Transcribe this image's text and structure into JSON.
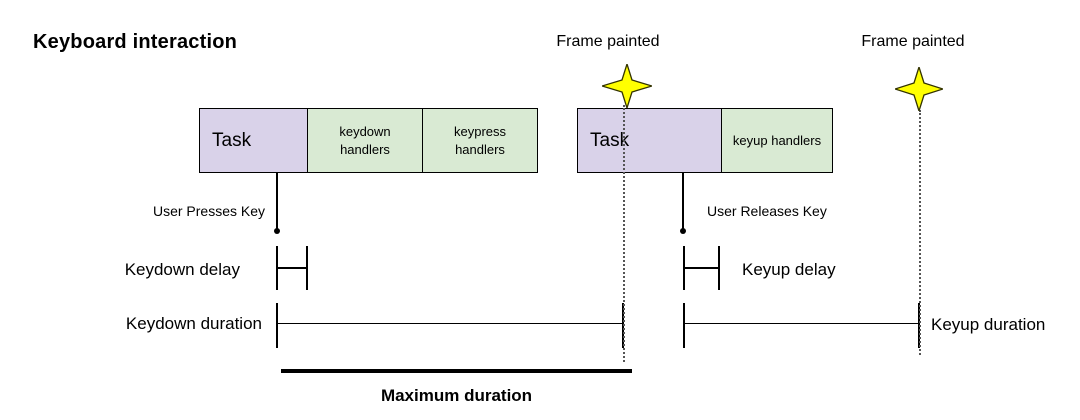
{
  "title": "Keyboard interaction",
  "frame_events": {
    "first": "Frame painted",
    "second": "Frame painted"
  },
  "keydown_track": {
    "task": "Task",
    "keydown_handlers": "keydown\nhandlers",
    "keypress_handlers": "keypress\nhandlers",
    "user_action": "User Presses Key",
    "delay": "Keydown delay",
    "duration": "Keydown duration"
  },
  "keyup_track": {
    "task": "Task",
    "keyup_handlers": "keyup handlers",
    "user_action": "User Releases Key",
    "delay": "Keyup delay",
    "duration": "Keyup duration"
  },
  "maximum_duration": "Maximum duration",
  "colors": {
    "task_fill": "#d9d2e9",
    "handlers_fill": "#d9ead3",
    "star_fill": "#ffff00",
    "star_stroke": "#333300",
    "line": "#000000"
  }
}
